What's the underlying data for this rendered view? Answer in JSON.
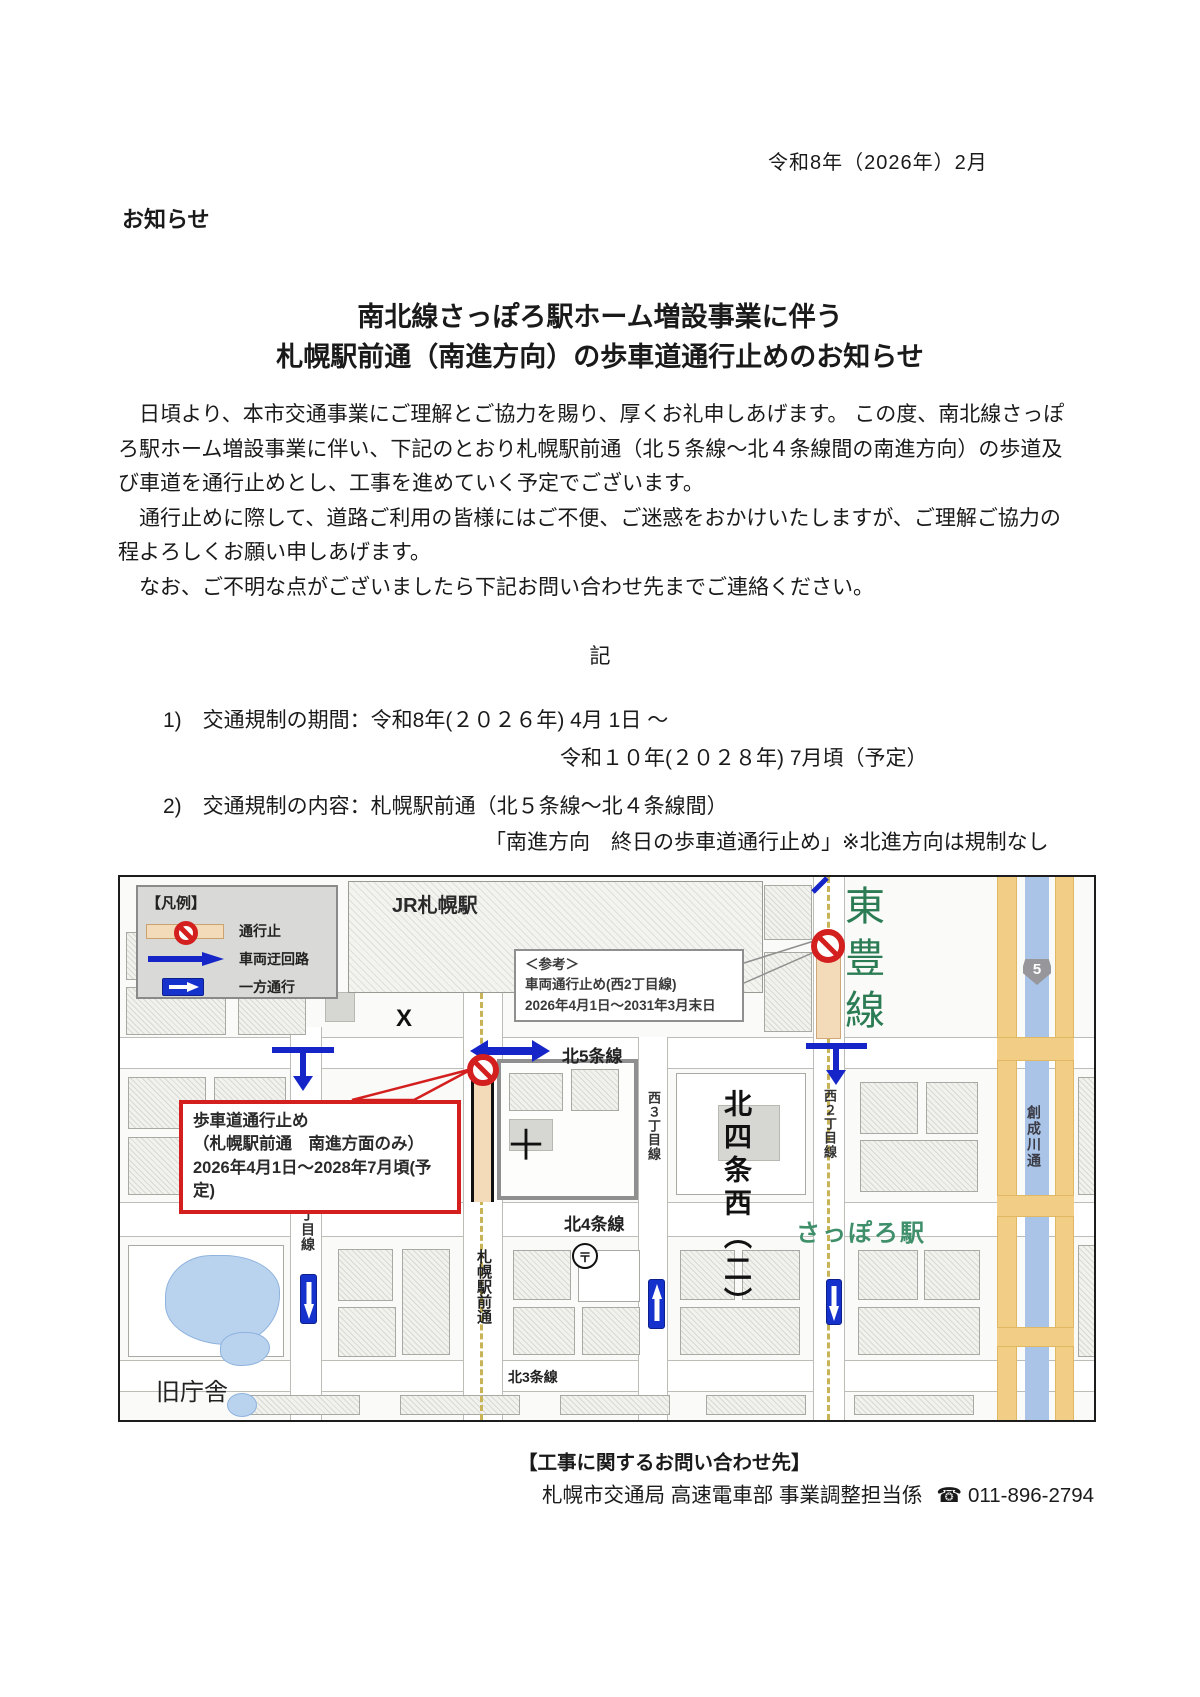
{
  "doc": {
    "date": "令和8年（2026年）2月",
    "notice_label": "お知らせ",
    "title_line1": "南北線さっぽろ駅ホーム増設事業に伴う",
    "title_line2": "札幌駅前通（南進方向）の歩車道通行止めのお知らせ",
    "para1": "　日頃より、本市交通事業にご理解とご協力を賜り、厚くお礼申しあげます。 この度、南北線さっぽろ駅ホーム増設事業に伴い、下記のとおり札幌駅前通（北５条線～北４条線間の南進方向）の歩道及び車道を通行止めとし、工事を進めていく予定でございます。",
    "para2": "　通行止めに際して、道路ご利用の皆様にはご不便、ご迷惑をおかけいたしますが、ご理解ご協力の程よろしくお願い申しあげます。",
    "para3": "　なお、ご不明な点がございましたら下記お問い合わせ先までご連絡ください。",
    "ki": "記",
    "item1_line1": "1)　交通規制の期間：令和8年(２０２６年) 4月 1日 ～",
    "item1_line2": "令和１０年(２０２８年) 7月頃（予定）",
    "item2_line1": "2)　交通規制の内容：札幌駅前通（北５条線～北４条線間）",
    "item2_line2": "「南進方向　終日の歩車道通行止め」※北進方向は規制なし"
  },
  "legend": {
    "title": "【凡例】",
    "closed": "通行止",
    "detour": "車両迂回路",
    "oneway": "一方通行"
  },
  "map": {
    "jr_station": "JR札幌駅",
    "toho_line": "東豊線",
    "ref_box": {
      "title": "＜参考＞",
      "line1": "車両通行止め(西2丁目線)",
      "line2": "2026年4月1日～2031年3月末日"
    },
    "closure_box": {
      "line1": "歩車道通行止め",
      "line2": "（札幌駅前通　南進方面のみ）",
      "line3": "2026年4月1日～2028年7月頃(予定)"
    },
    "roads": {
      "kita5": "北5条線",
      "kita4": "北4条線",
      "kita3": "北3条線",
      "nishi5": "西５丁目線",
      "nishi3": "西３丁目線",
      "nishi2": "西２丁目線",
      "ekimae": "札幌駅前通",
      "sosei": "創成川通"
    },
    "labels": {
      "kita4_nishi2": "北四条西（二）",
      "sapporo_station": "さっぽろ駅",
      "old_hall": "旧庁舎",
      "route5": "5",
      "x_mark": "X",
      "cross_mark": "＋",
      "post_mark": "〒"
    }
  },
  "contact": {
    "heading": "【工事に関するお問い合わせ先】",
    "org": "札幌市交通局 高速電車部 事業調整担当係",
    "phone_icon": "☎",
    "phone": "011-896-2794"
  }
}
